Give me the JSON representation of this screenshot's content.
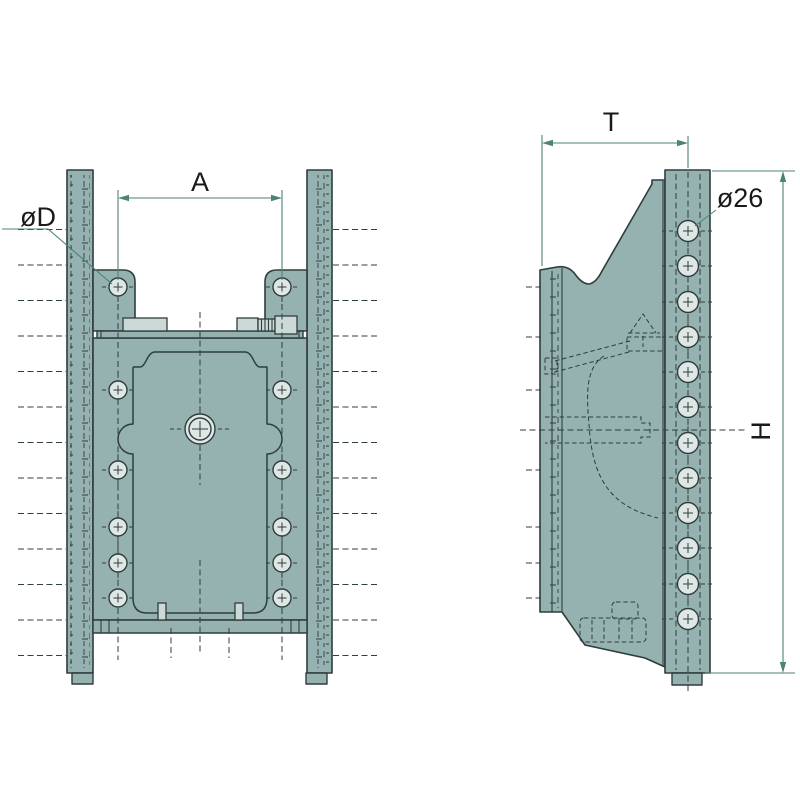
{
  "labels": {
    "plate_hole_diameter": "øD",
    "hole_spacing_width": "A",
    "depth": "T",
    "rail_hole_diameter": "ø26",
    "height": "H"
  },
  "colors": {
    "bg": "#ffffff",
    "body": "#95b2b0",
    "light": "#dfe7e5",
    "pad": "#cdd9d7",
    "outline": "#2e3d3d",
    "dim": "#4d8277",
    "text": "#1a1a1a"
  }
}
